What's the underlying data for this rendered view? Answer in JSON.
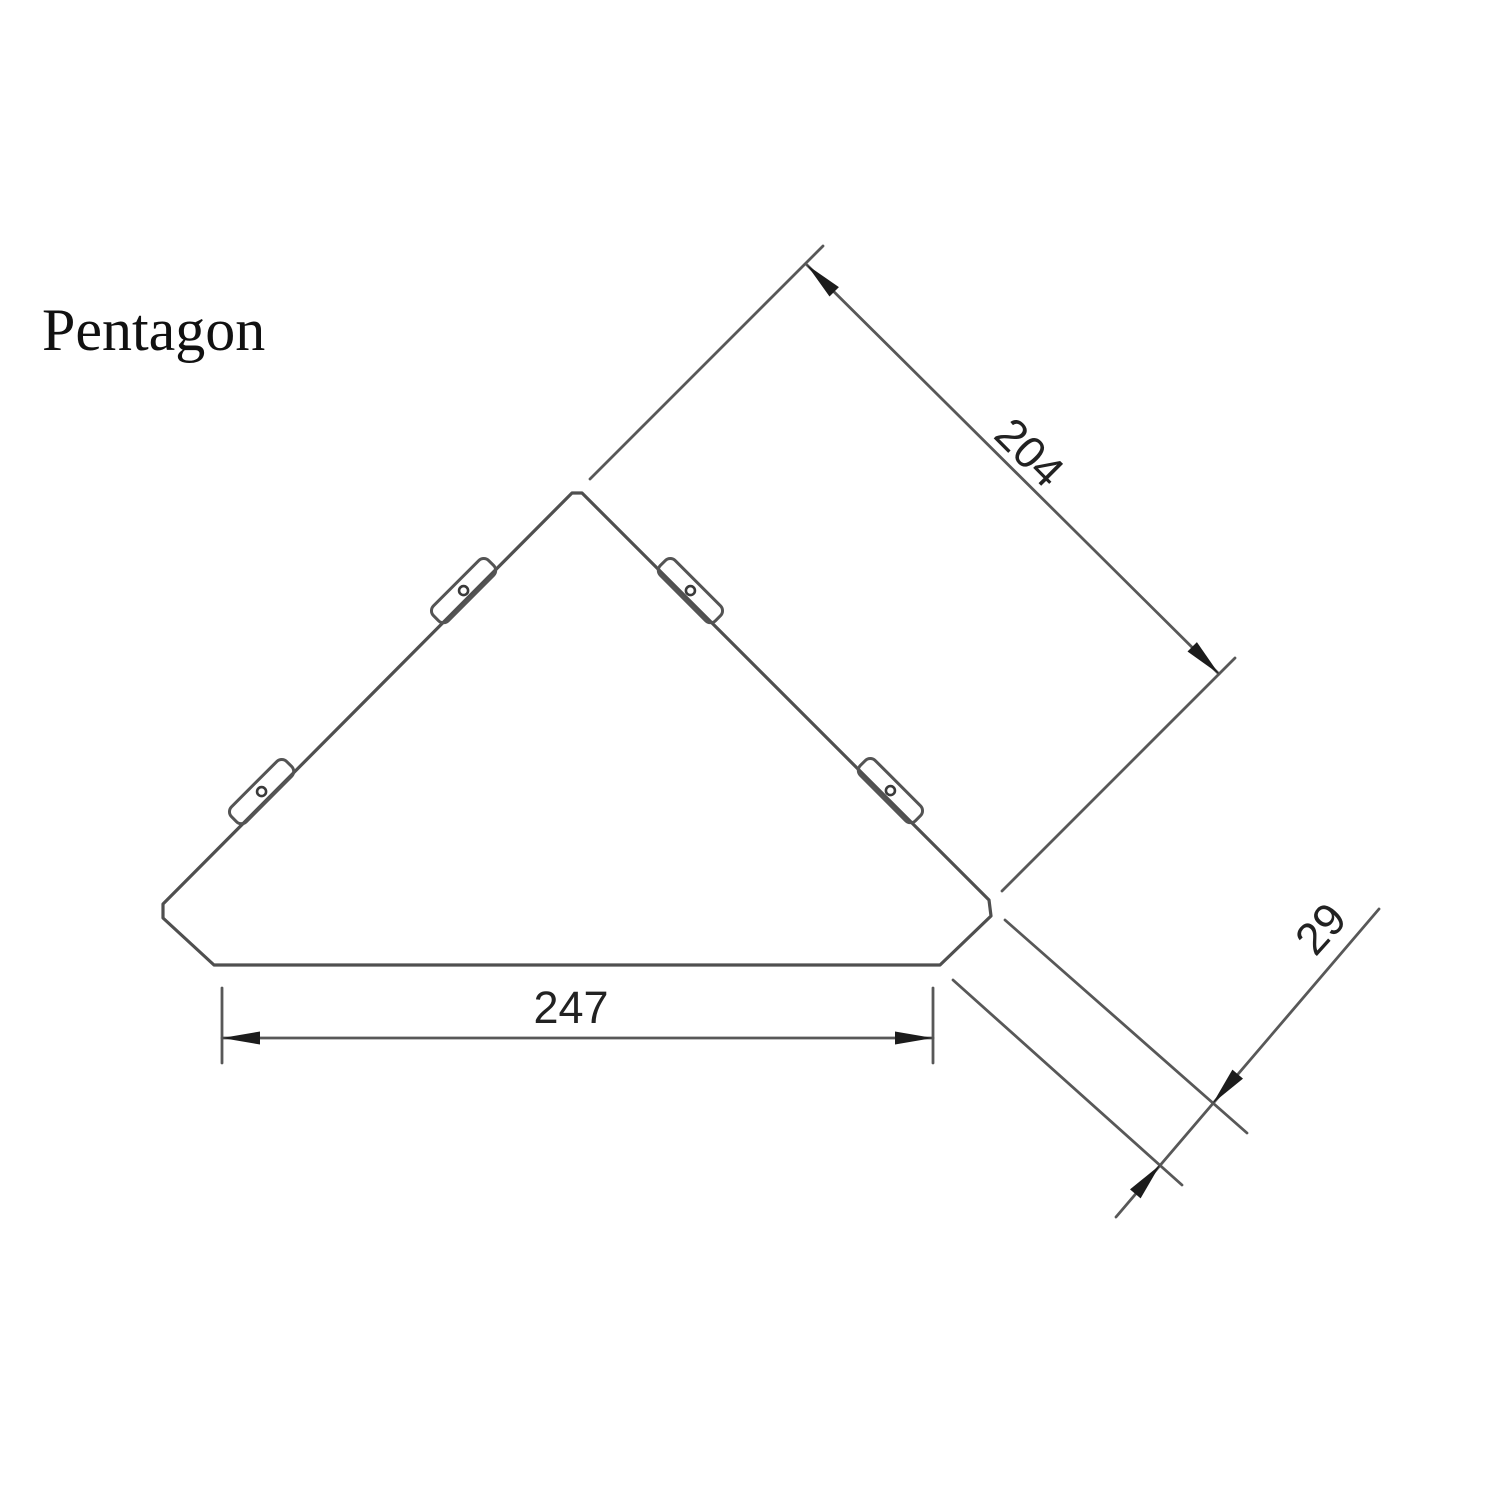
{
  "title": {
    "label": "Pentagon"
  },
  "drawing": {
    "shape": "pentagon corner shelf outline",
    "tabs_count": 4,
    "dimensions": {
      "side_length": "204",
      "bottom_width": "247",
      "corner_bevel": "29"
    },
    "colors": {
      "line": "#545454",
      "outline": "#4f4f4f",
      "text": "#222222",
      "arrow": "#1c1c1c",
      "background": "#ffffff"
    }
  }
}
